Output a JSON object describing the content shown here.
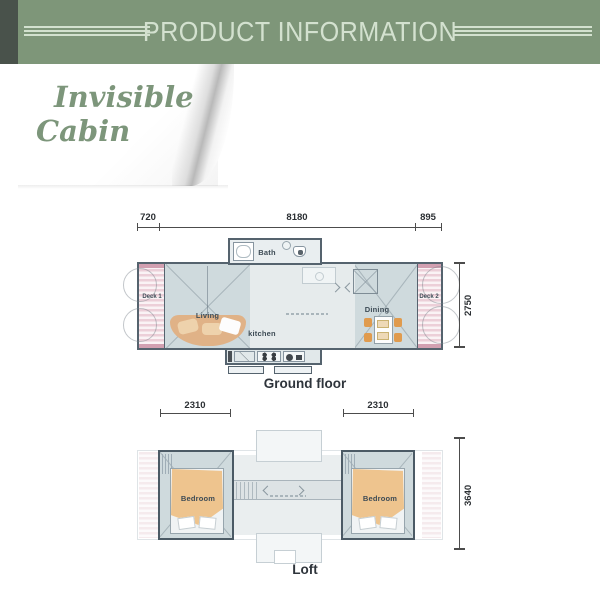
{
  "header": {
    "title": "PRODUCT INFORMATION"
  },
  "cover_note": {
    "line1": "Invisible",
    "line2": "Cabin"
  },
  "ground_floor": {
    "caption": "Ground floor",
    "dimensions": {
      "top_left": "720",
      "top_middle": "8180",
      "top_right": "895",
      "right_side": "2750"
    },
    "rooms": {
      "deck1": "Deck 1",
      "living": "Living",
      "bath": "Bath",
      "kitchen": "kitchen",
      "dining": "Dining",
      "deck2": "Deck 2"
    }
  },
  "loft": {
    "caption": "Loft",
    "dimensions": {
      "top_left": "2310",
      "top_right": "2310",
      "right_side": "3640"
    },
    "rooms": {
      "bedroom_left": "Bedroom",
      "bedroom_right": "Bedroom"
    }
  },
  "colors": {
    "banner_green": "#7e9679",
    "banner_text": "#d3e1cf",
    "banner_corner_block": "#49524b",
    "script_text": "#7d967b",
    "plan_fill": "#cfdadd",
    "plan_light": "#e6ebec",
    "wall": "#55636e",
    "deck_pink": "#eccfd8",
    "deck_cap": "#d2a0b1",
    "sofa_tan": "#e0b287",
    "bed_tan": "#eec48e",
    "chair_orange": "#e09b4e",
    "dimension_line": "#4c4c4c"
  }
}
